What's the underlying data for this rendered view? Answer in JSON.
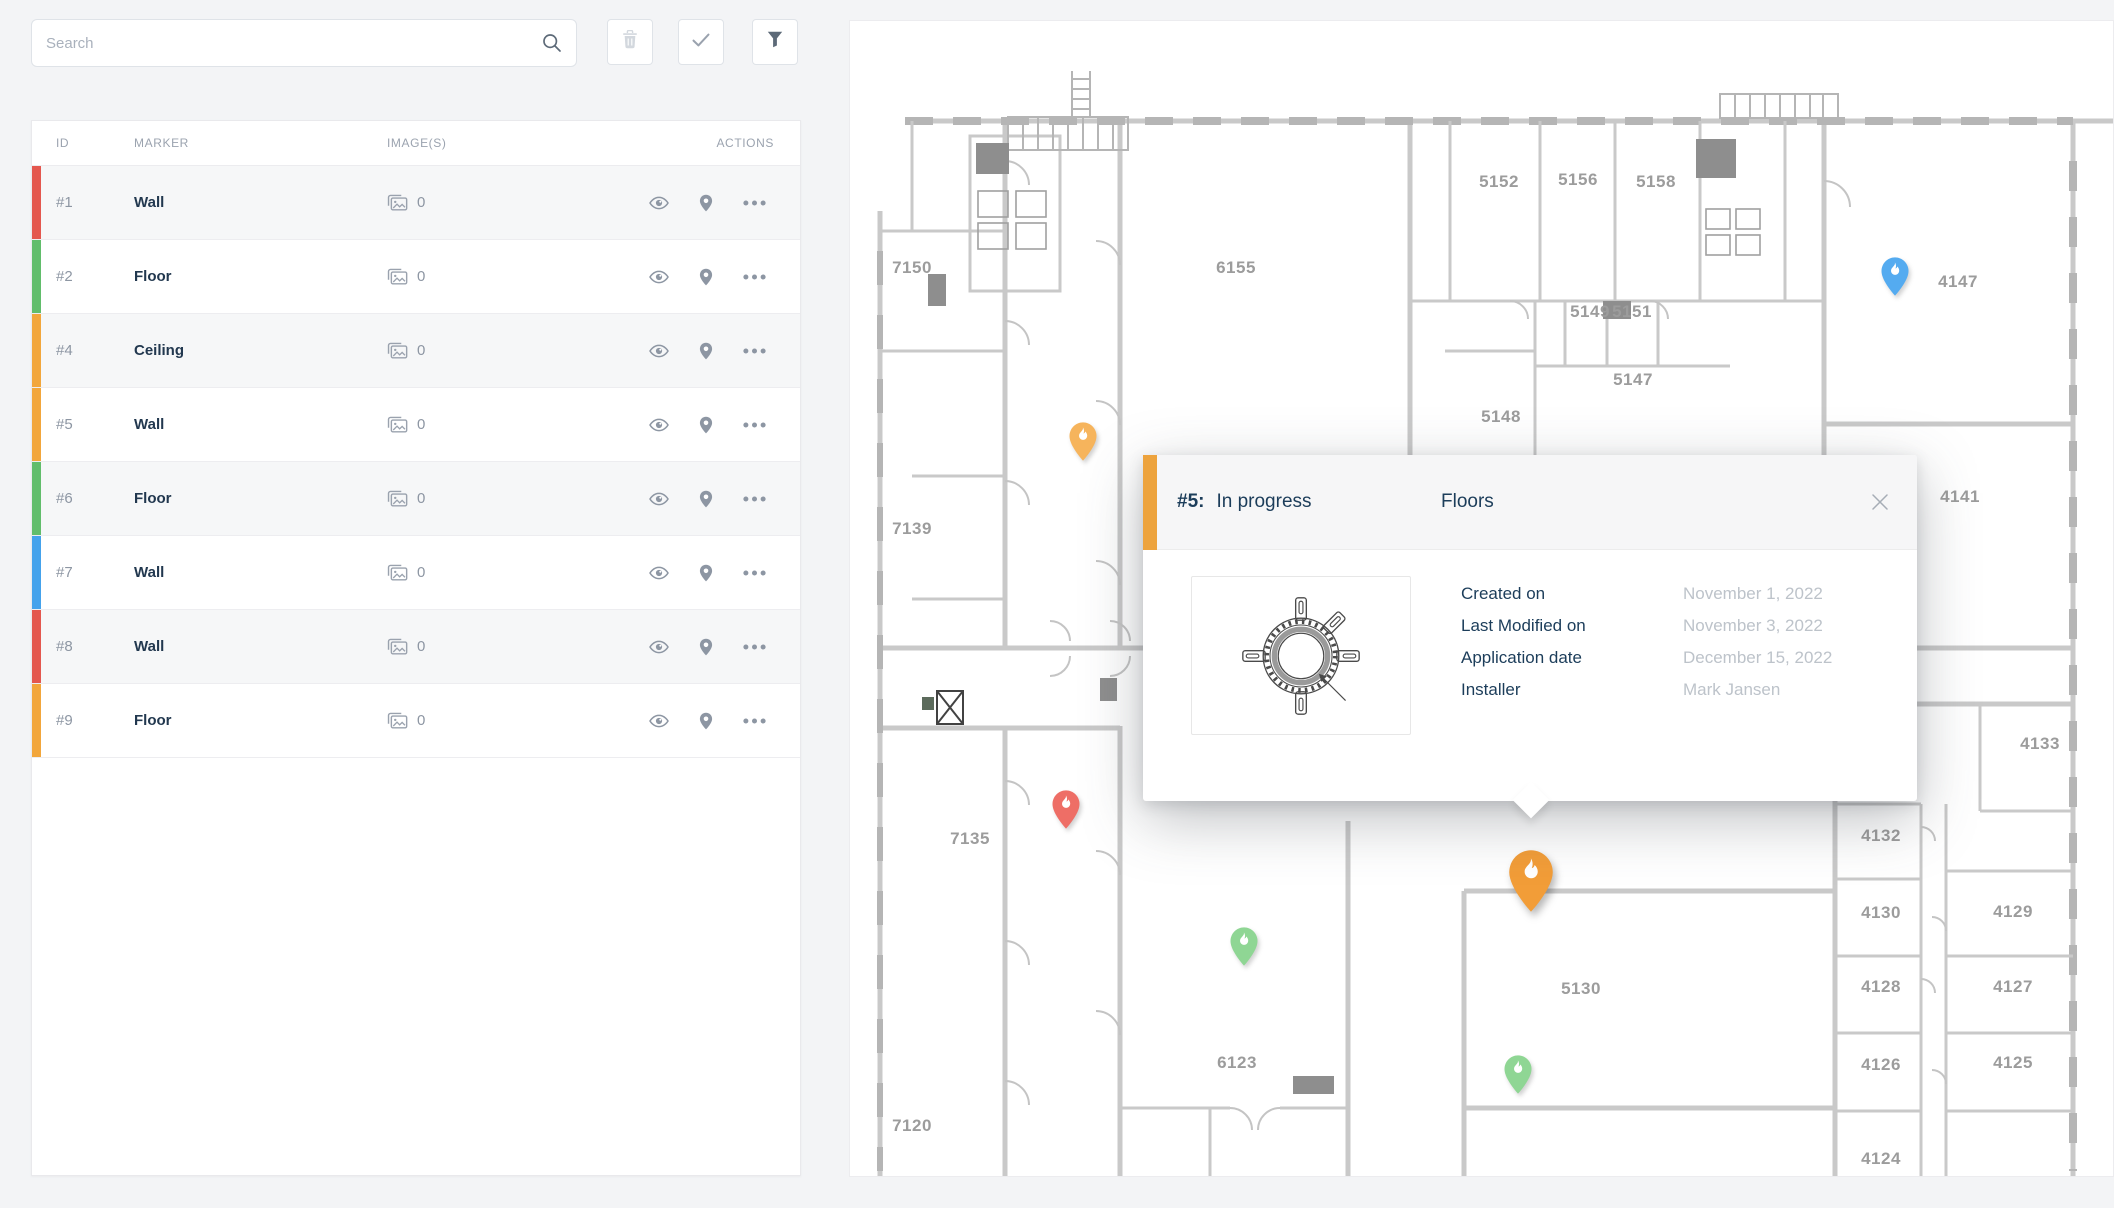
{
  "search": {
    "placeholder": "Search",
    "icon": "search-icon"
  },
  "toolbar": {
    "buttons": [
      {
        "name": "delete",
        "icon": "trash-icon",
        "disabled": true
      },
      {
        "name": "confirm",
        "icon": "check-icon",
        "disabled": false
      },
      {
        "name": "filter",
        "icon": "filter-icon",
        "disabled": false
      }
    ]
  },
  "table": {
    "columns": [
      "ID",
      "MARKER",
      "IMAGE(S)",
      "ACTIONS"
    ],
    "images_icon": "photos-icon",
    "action_icons": [
      "eye-icon",
      "map-pin-icon",
      "ellipsis-icon"
    ],
    "rows": [
      {
        "id": "#1",
        "marker": "Wall",
        "images": "0",
        "color": "#E4574E"
      },
      {
        "id": "#2",
        "marker": "Floor",
        "images": "0",
        "color": "#61BD6B"
      },
      {
        "id": "#4",
        "marker": "Ceiling",
        "images": "0",
        "color": "#F2A63B"
      },
      {
        "id": "#5",
        "marker": "Wall",
        "images": "0",
        "color": "#F2A63B"
      },
      {
        "id": "#6",
        "marker": "Floor",
        "images": "0",
        "color": "#61BD6B"
      },
      {
        "id": "#7",
        "marker": "Wall",
        "images": "0",
        "color": "#44A2EC"
      },
      {
        "id": "#8",
        "marker": "Wall",
        "images": "0",
        "color": "#E4574E"
      },
      {
        "id": "#9",
        "marker": "Floor",
        "images": "0",
        "color": "#F2A63B"
      }
    ]
  },
  "map": {
    "wall_color": "#c9c9c9",
    "label_color": "#9c9c9c",
    "rooms": [
      {
        "label": "7150",
        "x": 62,
        "y": 252
      },
      {
        "label": "6155",
        "x": 386,
        "y": 252
      },
      {
        "label": "5152",
        "x": 649,
        "y": 166
      },
      {
        "label": "5156",
        "x": 728,
        "y": 164
      },
      {
        "label": "5158",
        "x": 806,
        "y": 166
      },
      {
        "label": "5149",
        "x": 740,
        "y": 296
      },
      {
        "label": "5151",
        "x": 782,
        "y": 296
      },
      {
        "label": "5147",
        "x": 783,
        "y": 364
      },
      {
        "label": "5148",
        "x": 651,
        "y": 401
      },
      {
        "label": "4147",
        "x": 1108,
        "y": 266
      },
      {
        "label": "7139",
        "x": 62,
        "y": 513
      },
      {
        "label": "4141",
        "x": 1110,
        "y": 481
      },
      {
        "label": "4133",
        "x": 1190,
        "y": 728
      },
      {
        "label": "7135",
        "x": 120,
        "y": 823
      },
      {
        "label": "4132",
        "x": 1031,
        "y": 820
      },
      {
        "label": "4130",
        "x": 1031,
        "y": 897
      },
      {
        "label": "4129",
        "x": 1163,
        "y": 896
      },
      {
        "label": "4128",
        "x": 1031,
        "y": 971
      },
      {
        "label": "4127",
        "x": 1163,
        "y": 971
      },
      {
        "label": "4126",
        "x": 1031,
        "y": 1049
      },
      {
        "label": "4125",
        "x": 1163,
        "y": 1047
      },
      {
        "label": "5130",
        "x": 731,
        "y": 973
      },
      {
        "label": "6123",
        "x": 387,
        "y": 1047
      },
      {
        "label": "7120",
        "x": 62,
        "y": 1110
      },
      {
        "label": "4124",
        "x": 1031,
        "y": 1143
      }
    ],
    "pins": [
      {
        "icon": "flame-pin-icon",
        "color": "#F6B45C",
        "x": 233,
        "tip": 441,
        "size": "small"
      },
      {
        "icon": "flame-pin-icon",
        "color": "#54ABF0",
        "x": 1045,
        "tip": 276,
        "size": "small"
      },
      {
        "icon": "flame-pin-icon",
        "color": "#EE6E66",
        "x": 216,
        "tip": 809,
        "size": "small"
      },
      {
        "icon": "flame-pin-icon",
        "color": "#8FD694",
        "x": 394,
        "tip": 946,
        "size": "small"
      },
      {
        "icon": "flame-pin-icon",
        "color": "#8FD694",
        "x": 668,
        "tip": 1074,
        "size": "small"
      },
      {
        "icon": "flame-pin-icon",
        "color": "#F29D38",
        "x": 681,
        "tip": 893,
        "size": "large",
        "selected": true
      }
    ]
  },
  "popup": {
    "accent_color": "#EDA33D",
    "marker_id": "#5:",
    "status": "In progress",
    "category": "Floors",
    "close_icon": "close-icon",
    "thumbnail": "ring-gasket-illustration",
    "fields": [
      {
        "label": "Created on",
        "value": "November 1, 2022"
      },
      {
        "label": "Last Modified on",
        "value": "November 3, 2022"
      },
      {
        "label": "Application date",
        "value": "December 15, 2022"
      },
      {
        "label": "Installer",
        "value": "Mark Jansen"
      }
    ]
  }
}
